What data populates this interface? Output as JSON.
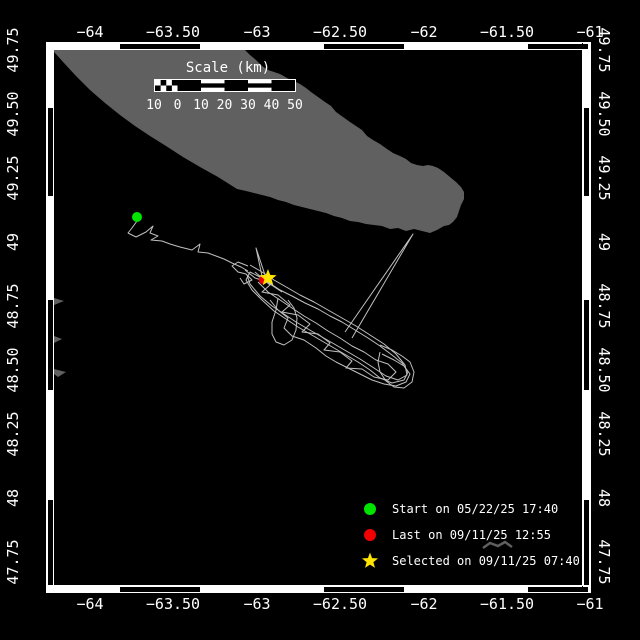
{
  "colors": {
    "background": "#000000",
    "frame": "#ffffff",
    "land": "#606060",
    "track": "#c0c0c0",
    "start_marker": "#00e400",
    "last_marker": "#f00000",
    "selected_marker": "#ffe400",
    "text": "#ffffff"
  },
  "axes": {
    "lon_labels": [
      {
        "label": "−64",
        "x": 90
      },
      {
        "label": "−63.50",
        "x": 173
      },
      {
        "label": "−63",
        "x": 257
      },
      {
        "label": "−62.50",
        "x": 340
      },
      {
        "label": "−62",
        "x": 424
      },
      {
        "label": "−61.50",
        "x": 507
      },
      {
        "label": "−61",
        "x": 590
      }
    ],
    "lat_labels": [
      {
        "label": "49.75",
        "y": 50
      },
      {
        "label": "49.50",
        "y": 114
      },
      {
        "label": "49.25",
        "y": 178
      },
      {
        "label": "49",
        "y": 242
      },
      {
        "label": "48.75",
        "y": 306
      },
      {
        "label": "48.50",
        "y": 370
      },
      {
        "label": "48.25",
        "y": 434
      },
      {
        "label": "48",
        "y": 498
      },
      {
        "label": "47.75",
        "y": 562
      }
    ],
    "top_y": 32,
    "bottom_y": 604,
    "left_x": 13,
    "right_x": 604
  },
  "frame": {
    "h_black": [
      [
        120,
        200
      ],
      [
        324,
        404
      ],
      [
        528,
        588
      ]
    ],
    "v_black": [
      [
        108,
        196
      ],
      [
        300,
        390
      ],
      [
        500,
        585
      ]
    ]
  },
  "scalebar": {
    "title": "Scale (km)",
    "labels": [
      "10",
      "0",
      "10",
      "20",
      "30",
      "40",
      "50"
    ]
  },
  "legend": {
    "rows_y": [
      509,
      535,
      561
    ],
    "items": [
      {
        "marker": "circle",
        "color": "#00e400",
        "label": "Start on 05/22/25 17:40"
      },
      {
        "marker": "circle",
        "color": "#f00000",
        "label": "Last on 09/11/25 12:55"
      },
      {
        "marker": "star",
        "color": "#ffe400",
        "label": "Selected on 09/11/25 07:40"
      }
    ]
  },
  "map": {
    "island": "52,50 245,50 250,55 256,60 262,66 268,70 274,72 280,74 287,78 294,81 300,84 306,88 311,92 318,97 325,102 331,106 336,112 343,117 350,122 356,126 362,130 367,136 373,140 380,144 387,149 393,153 400,156 406,159 411,163 417,165 423,166 428,165 433,166 438,168 444,172 450,177 456,182 461,187 464,192 464,199 461,205 459,211 457,217 453,222 449,225 444,226 437,230 430,233 422,231 414,229 406,231 398,228 390,229 382,226 374,225 366,224 358,222 350,221 342,218 334,216 326,213 318,211 310,209 302,207 294,205 286,202 278,200 270,197 262,195 254,193 246,191 237,189 218,177 200,167 183,157 166,146 150,136 135,126 120,115 105,103 90,90 76,76 64,63 55,53",
    "islets": [
      "54,298 64,301 54,305",
      "54,336 62,339 54,343",
      "54,369 66,372 58,377 54,374"
    ],
    "small_island": "483,548 490,543 498,546 505,542 512,547",
    "track_segments": [
      "137,221 132,228 128,233 136,237 146,232 153,226 150,233 158,236 151,240 162,241 170,244 180,247 192,250 200,244 198,252 208,253 216,256 224,259 232,263 241,267 248,271",
      "245,270 255,278 268,282 280,290 292,296 305,303 318,309 330,316 342,322 355,330 368,338 380,346 392,355 402,363 408,372 404,380 392,383 380,378 370,370 358,362 346,355 334,348 322,341 310,334 298,327 286,319 274,311 262,300 252,290 246,280 250,272 258,276 270,284 282,292",
      "250,265 262,272 274,280 288,288 300,295 314,302 328,310 342,318 356,326 370,335 384,344 396,354 405,365 407,375 398,380 386,376 374,368 360,359 348,352 336,345 322,337 308,329 296,322 284,314 272,306 260,296 250,284 247,275",
      "255,272 270,285 262,292 278,295 290,305 282,312 298,315 310,324 302,332 318,334 330,343 324,350 340,352 352,361 346,368 362,369 374,377 388,380 396,372 388,364 376,360 364,352 352,346 340,338 328,331 316,323 304,316 292,308 280,300 268,292 258,282",
      "270,300 278,310 288,318 284,328 292,336 304,340 316,348 326,356 336,362 348,368 360,374 372,380 384,384 396,386 406,382 410,374 404,366 394,360 382,354",
      "278,298 276,310 272,322 272,334 276,342 284,345 292,340 296,330 297,318 294,308 288,300",
      "380,345 392,350 402,356 410,362 414,372 412,382 404,388 394,387 386,381 380,372 378,362 380,352",
      "262,276 256,248 266,278",
      "248,266 238,262 232,266 238,272 246,274 252,280 244,284 240,278",
      "345,332 413,234 352,338"
    ],
    "start": {
      "x": 137,
      "y": 217,
      "r": 5
    },
    "last": {
      "x": 263,
      "y": 280,
      "r": 4
    },
    "selected": {
      "x": 268,
      "y": 278,
      "r": 9
    }
  }
}
